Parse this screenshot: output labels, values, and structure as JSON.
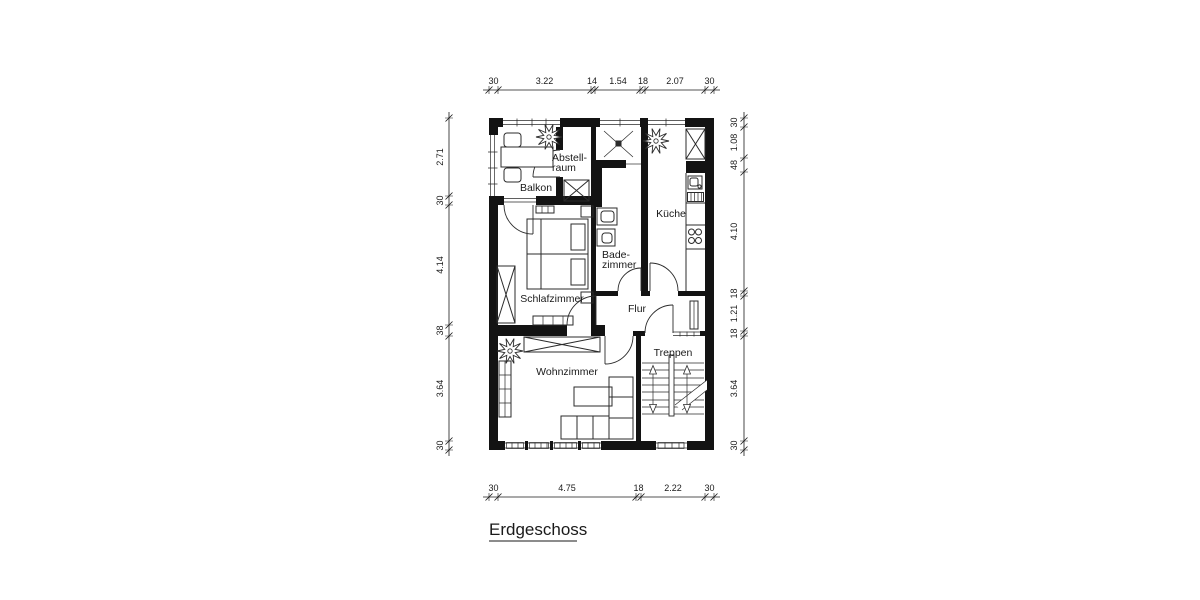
{
  "title": {
    "text": "Erdgeschoss"
  },
  "rooms": {
    "balkon": "Balkon",
    "abstellraum": [
      "Abstell-",
      "raum"
    ],
    "kueche": "Küche",
    "badezimmer": [
      "Bade-",
      "zimmer"
    ],
    "schlafzimmer": "Schlafzimmer",
    "flur": "Flur",
    "treppen": "Treppen",
    "wohnzimmer": "Wohnzimmer"
  },
  "dims": {
    "top": [
      "30",
      "3.22",
      "14",
      "1.54",
      "18",
      "2.07",
      "30"
    ],
    "bottom": [
      "30",
      "4.75",
      "18",
      "2.22",
      "30"
    ],
    "left": [
      "2.71",
      "30",
      "4.14",
      "38",
      "3.64",
      "30"
    ],
    "right": [
      "30",
      "1.08",
      "48",
      "4.10",
      "18",
      "1.21",
      "18",
      "3.64",
      "30"
    ]
  },
  "colors": {
    "wall": "#131313",
    "line": "#2b2b2b",
    "background": "#ffffff"
  }
}
